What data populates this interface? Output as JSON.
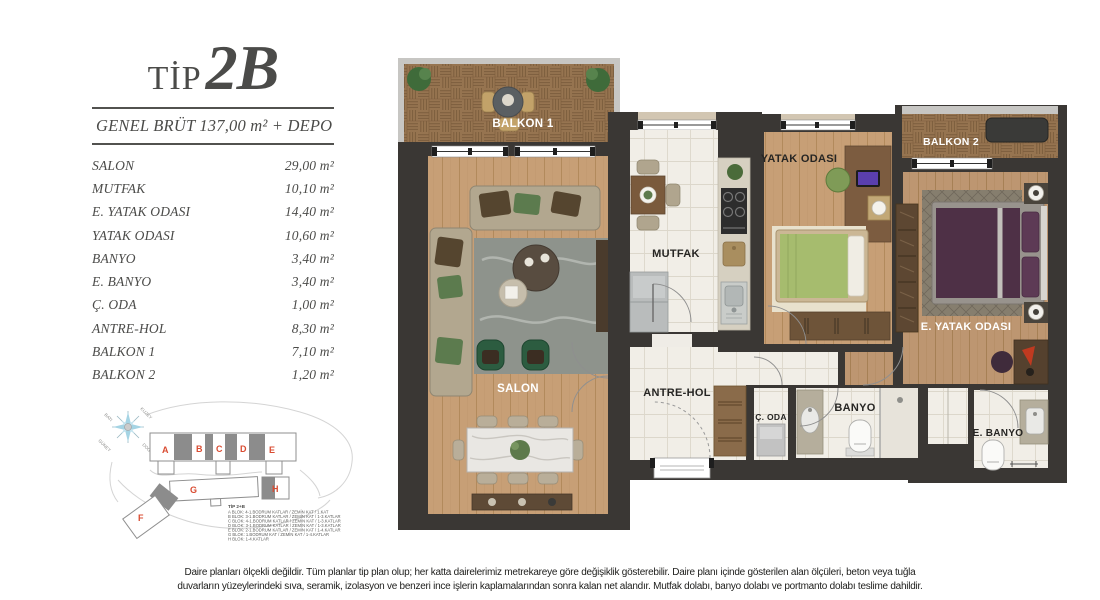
{
  "title": {
    "prefix": "TİP",
    "code": "2B"
  },
  "summary": "GENEL BRÜT 137,00 m² + DEPO",
  "rooms": [
    {
      "label": "SALON",
      "area": "29,00 m²"
    },
    {
      "label": "MUTFAK",
      "area": "10,10 m²"
    },
    {
      "label": "E. YATAK ODASI",
      "area": "14,40 m²"
    },
    {
      "label": "YATAK ODASI",
      "area": "10,60 m²"
    },
    {
      "label": "BANYO",
      "area": "3,40 m²"
    },
    {
      "label": "E. BANYO",
      "area": "3,40 m²"
    },
    {
      "label": "Ç. ODA",
      "area": "1,00 m²"
    },
    {
      "label": "ANTRE-HOL",
      "area": "8,30 m²"
    },
    {
      "label": "BALKON 1",
      "area": "7,10 m²"
    },
    {
      "label": "BALKON 2",
      "area": "1,20 m²"
    }
  ],
  "floorplan": {
    "labels": {
      "balkon1": "BALKON 1",
      "salon": "SALON",
      "mutfak": "MUTFAK",
      "yatak_odasi": "YATAK ODASI",
      "balkon2": "BALKON 2",
      "e_yatak_odasi": "E. YATAK ODASI",
      "antre_hol": "ANTRE-HOL",
      "c_oda": "Ç. ODA",
      "banyo": "BANYO",
      "e_banyo": "E. BANYO"
    }
  },
  "siteplan": {
    "compass": {
      "north": "KUZEY",
      "south": "GÜNEY",
      "east": "DOĞU",
      "west": "BATI"
    },
    "blocks": [
      "A",
      "B",
      "C",
      "D",
      "E",
      "F",
      "G",
      "H"
    ],
    "legend_title": "TİP 2+B",
    "legend": [
      "A BLOK:  4-1.BODRUM KATLAR / ZEMİN KAT / 1.KAT",
      "B BLOK:  3-1.BODRUM KATLAR / ZEMİN KAT / 1-3.KATLAR",
      "C BLOK:  4-1.BODRUM KATLAR / ZEMİN KAT / 1-3.KATLAR",
      "D BLOK:  3-1.BODRUM KATLAR / ZEMİN KAT / 1-3.KATLAR",
      "E BLOK:  2-1.BODRUM KATLAR / ZEMİN KAT / 1-4.KATLAR",
      "G BLOK:  1.BODRUM KAT / ZEMİN KAT / 1-4.KATLAR",
      "H BLOK:  1-4.KATLAR"
    ]
  },
  "disclaimer": {
    "line1": "Daire planları ölçekli değildir. Tüm planlar tip plan olup; her katta dairelerimiz metrekareye göre değişiklik gösterebilir. Daire planı içinde gösterilen alan ölçüleri, beton veya tuğla",
    "line2": "duvarların yüzeylerindeki sıva, seramik, izolasyon ve benzeri ince işlerin kaplamalarından sonra kalan net alandır. Mutfak dolabı, banyo dolabı ve portmanto dolabı teslime dahildir."
  },
  "colors": {
    "wall": "#3a3734",
    "accent_red": "#d94b31",
    "compass_blue": "#a5d4e4"
  }
}
